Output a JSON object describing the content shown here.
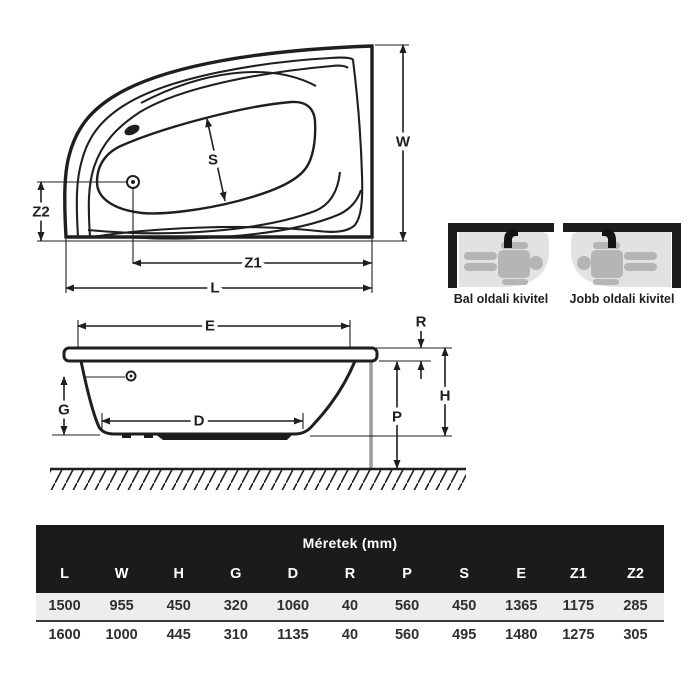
{
  "plan_view": {
    "labels": {
      "s": "S",
      "w": "W",
      "z2": "Z2",
      "z1": "Z1",
      "l": "L"
    }
  },
  "side_view": {
    "labels": {
      "e": "E",
      "r": "R",
      "h": "H",
      "p": "P",
      "g": "G",
      "d": "D"
    }
  },
  "variants": {
    "left": {
      "label": "Bal oldali kivitel"
    },
    "right": {
      "label": "Jobb oldali kivitel"
    }
  },
  "table": {
    "title": "Méretek (mm)",
    "columns": [
      "L",
      "W",
      "H",
      "G",
      "D",
      "R",
      "P",
      "S",
      "E",
      "Z1",
      "Z2"
    ],
    "rows": [
      {
        "values": [
          "1500",
          "955",
          "450",
          "320",
          "1060",
          "40",
          "560",
          "450",
          "1365",
          "1175",
          "285"
        ]
      },
      {
        "values": [
          "1600",
          "1000",
          "445",
          "310",
          "1135",
          "40",
          "560",
          "495",
          "1480",
          "1275",
          "305"
        ]
      }
    ]
  },
  "colors": {
    "line": "#1f1f1f",
    "table_header_bg": "#1b1b1b",
    "row_alt_bg": "#ededed",
    "pictogram_tub_gray": "#e2e2e2",
    "person_gray": "#b5b5b5",
    "support_gray": "#9c9c9c"
  }
}
